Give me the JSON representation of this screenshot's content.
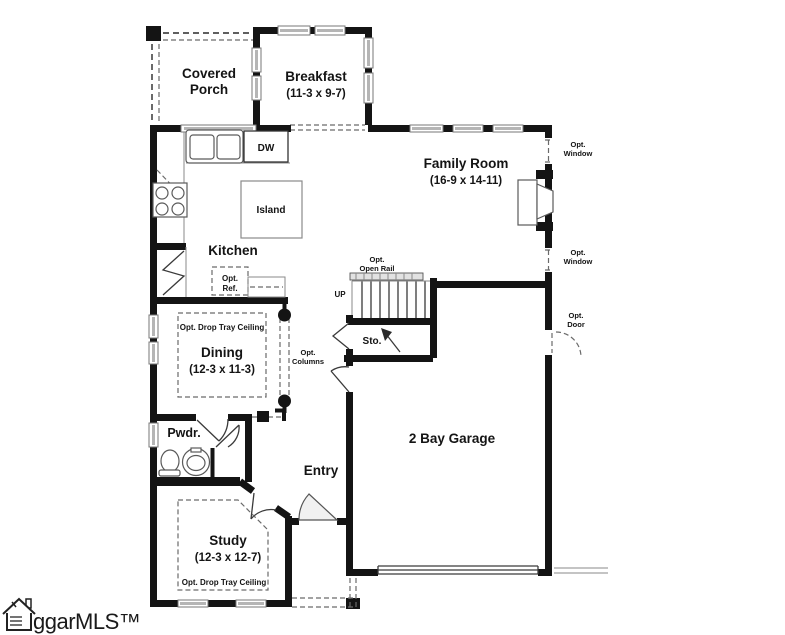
{
  "plan": {
    "rooms": {
      "covered_porch": {
        "line1": "Covered",
        "line2": "Porch"
      },
      "breakfast": {
        "name": "Breakfast",
        "dims": "(11-3 x 9-7)"
      },
      "family_room": {
        "name": "Family Room",
        "dims": "(16-9 x 14-11)"
      },
      "kitchen": {
        "name": "Kitchen"
      },
      "dining": {
        "name": "Dining",
        "dims": "(12-3 x 11-3)",
        "ceiling_note": "Opt. Drop Tray Ceiling"
      },
      "powder": {
        "name": "Pwdr."
      },
      "entry": {
        "name": "Entry"
      },
      "garage": {
        "name": "2 Bay Garage"
      },
      "study": {
        "name": "Study",
        "dims": "(12-3 x 12-7)",
        "ceiling_note": "Opt. Drop Tray Ceiling"
      }
    },
    "fixtures": {
      "island": "Island",
      "dishwasher": "DW",
      "opt_ref": {
        "line1": "Opt.",
        "line2": "Ref."
      },
      "stairs": {
        "up": "UP",
        "rail_line1": "Opt.",
        "rail_line2": "Open Rail",
        "storage": "Sto."
      }
    },
    "options": {
      "columns": {
        "line1": "Opt.",
        "line2": "Columns"
      },
      "window": {
        "line1": "Opt.",
        "line2": "Window"
      },
      "door": {
        "line1": "Opt.",
        "line2": "Door"
      }
    },
    "watermark": "ggarMLS™",
    "colors": {
      "wall": "#141414",
      "window_bar": "#b5b5b5"
    }
  }
}
